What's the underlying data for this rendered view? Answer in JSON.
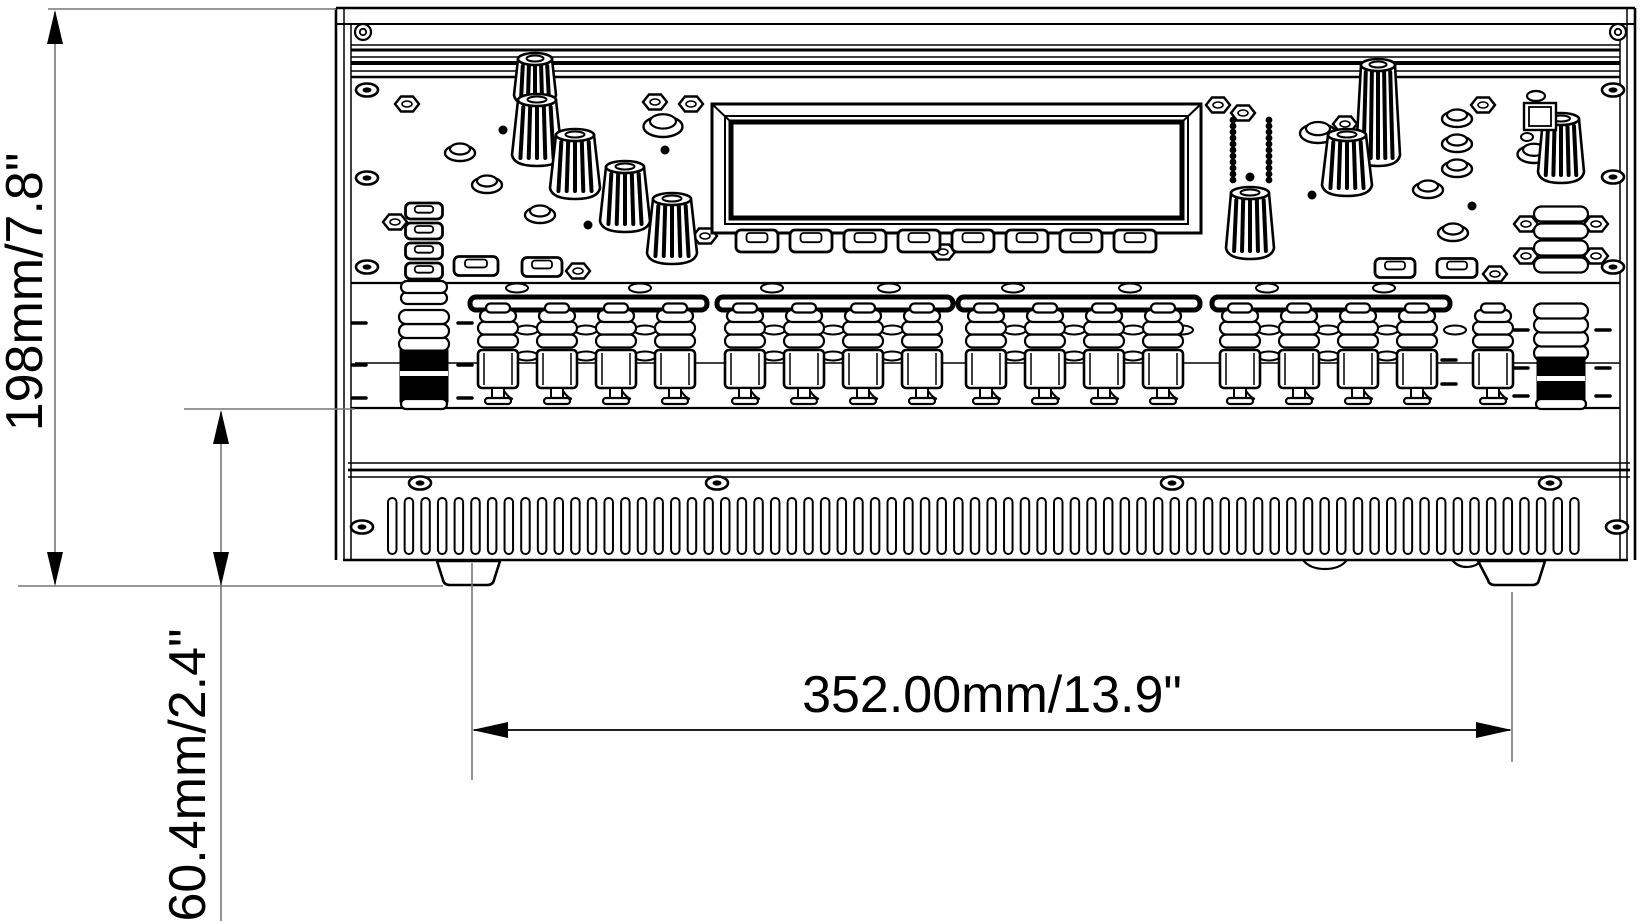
{
  "figure": {
    "type": "technical-dimension-drawing",
    "subject": "mixer-front-panel",
    "background": "#ffffff",
    "device_line_color": "#000000",
    "dimension_line_color": "#777777"
  },
  "dimensions": {
    "height": {
      "label": "198mm/7.8\"",
      "orientation": "vertical"
    },
    "bottom_height": {
      "label": "60.4mm/2.4\"",
      "orientation": "vertical"
    },
    "width": {
      "label": "352.00mm/13.9\"",
      "orientation": "horizontal"
    }
  }
}
